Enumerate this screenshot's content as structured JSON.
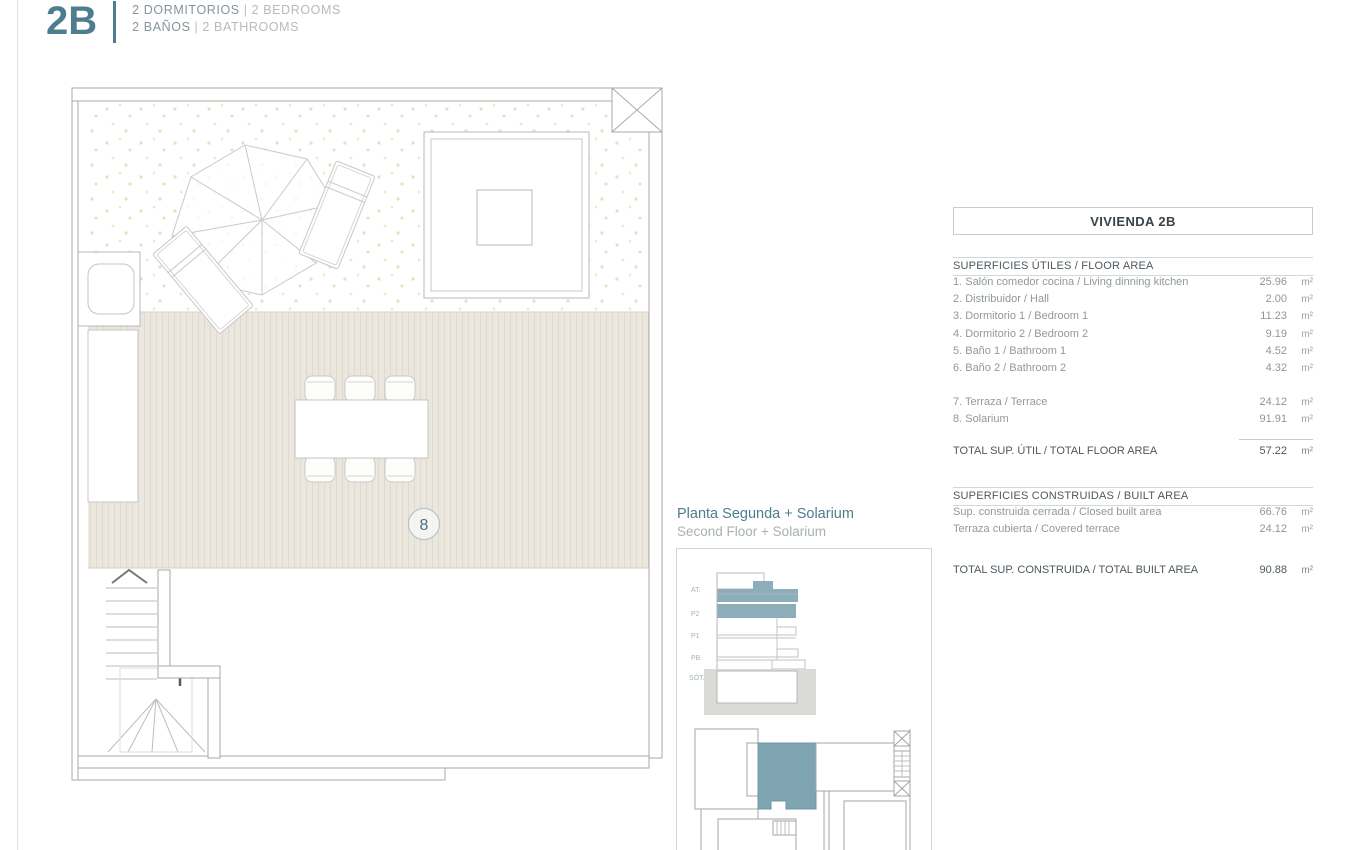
{
  "header": {
    "unit_code": "2B",
    "separator": "|",
    "line1_es": "2 DORMITORIOS",
    "line1_en": "2 BEDROOMS",
    "line2_es": "2 BAÑOS",
    "line2_en": "2 BATHROOMS"
  },
  "plan": {
    "room_number": "8"
  },
  "floor_label": {
    "es": "Planta Segunda + Solarium",
    "en": "Second Floor + Solarium"
  },
  "section_diagram": {
    "levels": [
      "AT.",
      "P2",
      "P1",
      "PB",
      "SÓT."
    ]
  },
  "areas_panel": {
    "title": "VIVIENDA 2B",
    "useful": {
      "heading": "SUPERFICIES ÚTILES / FLOOR AREA",
      "rows": [
        {
          "label": "1. Salón comedor cocina / Living dinning kitchen",
          "value": "25.96",
          "unit": "m²"
        },
        {
          "label": "2. Distribuidor / Hall",
          "value": "2.00",
          "unit": "m²"
        },
        {
          "label": "3. Dormitorio 1 / Bedroom 1",
          "value": "11.23",
          "unit": "m²"
        },
        {
          "label": "4. Dormitorio 2 / Bedroom 2",
          "value": "9.19",
          "unit": "m²"
        },
        {
          "label": "5. Baño 1 / Bathroom 1",
          "value": "4.52",
          "unit": "m²"
        },
        {
          "label": "6. Baño 2 / Bathroom 2",
          "value": "4.32",
          "unit": "m²"
        }
      ],
      "outdoor_rows": [
        {
          "label": "7. Terraza / Terrace",
          "value": "24.12",
          "unit": "m²"
        },
        {
          "label": "8. Solarium",
          "value": "91.91",
          "unit": "m²"
        }
      ],
      "total": {
        "label": "TOTAL SUP. ÚTIL / TOTAL FLOOR AREA",
        "value": "57.22",
        "unit": "m²"
      }
    },
    "built": {
      "heading": "SUPERFICIES CONSTRUIDAS / BUILT AREA",
      "rows": [
        {
          "label": "Sup. construida cerrada / Closed built area",
          "value": "66.76",
          "unit": "m²"
        },
        {
          "label": "Terraza cubierta / Covered terrace",
          "value": "24.12",
          "unit": "m²"
        }
      ],
      "total": {
        "label": "TOTAL SUP. CONSTRUIDA /  TOTAL BUILT AREA",
        "value": "90.88",
        "unit": "m²"
      }
    }
  },
  "colors": {
    "accent_teal": "#4e7d90",
    "highlight_fill": "#7fa5b2",
    "deck_fill": "#ece7de",
    "ground_gray": "#dadad7"
  }
}
